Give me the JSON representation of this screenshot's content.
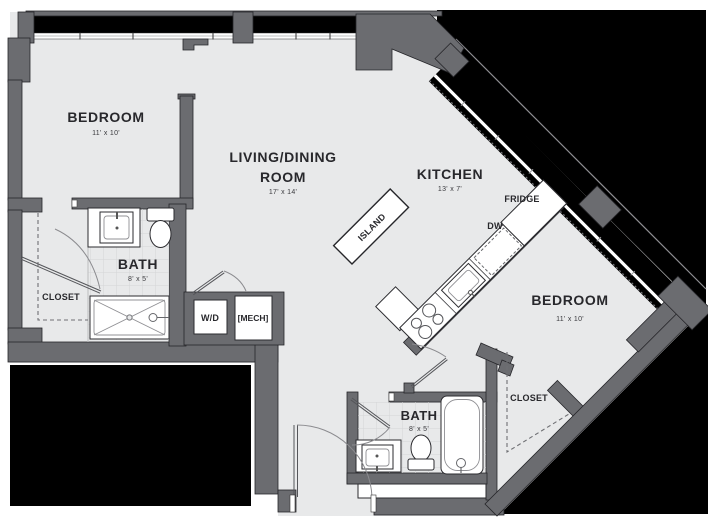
{
  "title": "Apartment Floor Plan",
  "colors": {
    "wall": "#6b6c70",
    "floor": "#e8e9ea",
    "exterior": "#000000",
    "fixture": "#ffffff"
  },
  "rooms": [
    {
      "id": "bedroom-1",
      "name": "BEDROOM",
      "dims": "11' x 10'"
    },
    {
      "id": "living-dining",
      "name_line1": "LIVING/DINING",
      "name_line2": "ROOM",
      "dims": "17' x 14'"
    },
    {
      "id": "kitchen",
      "name": "KITCHEN",
      "dims": "13' x 7'"
    },
    {
      "id": "bath-1",
      "name": "BATH",
      "dims": "8' x 5'"
    },
    {
      "id": "bedroom-2",
      "name": "BEDROOM",
      "dims": "11' x 10'"
    },
    {
      "id": "bath-2",
      "name": "BATH",
      "dims": "8' x 5'"
    }
  ],
  "labels": {
    "closet_left": "CLOSET",
    "closet_right": "CLOSET",
    "island": "ISLAND",
    "fridge": "FRIDGE",
    "dishwasher": "DW",
    "washer_dryer": "W/D",
    "mechanical": "[MECH]"
  }
}
